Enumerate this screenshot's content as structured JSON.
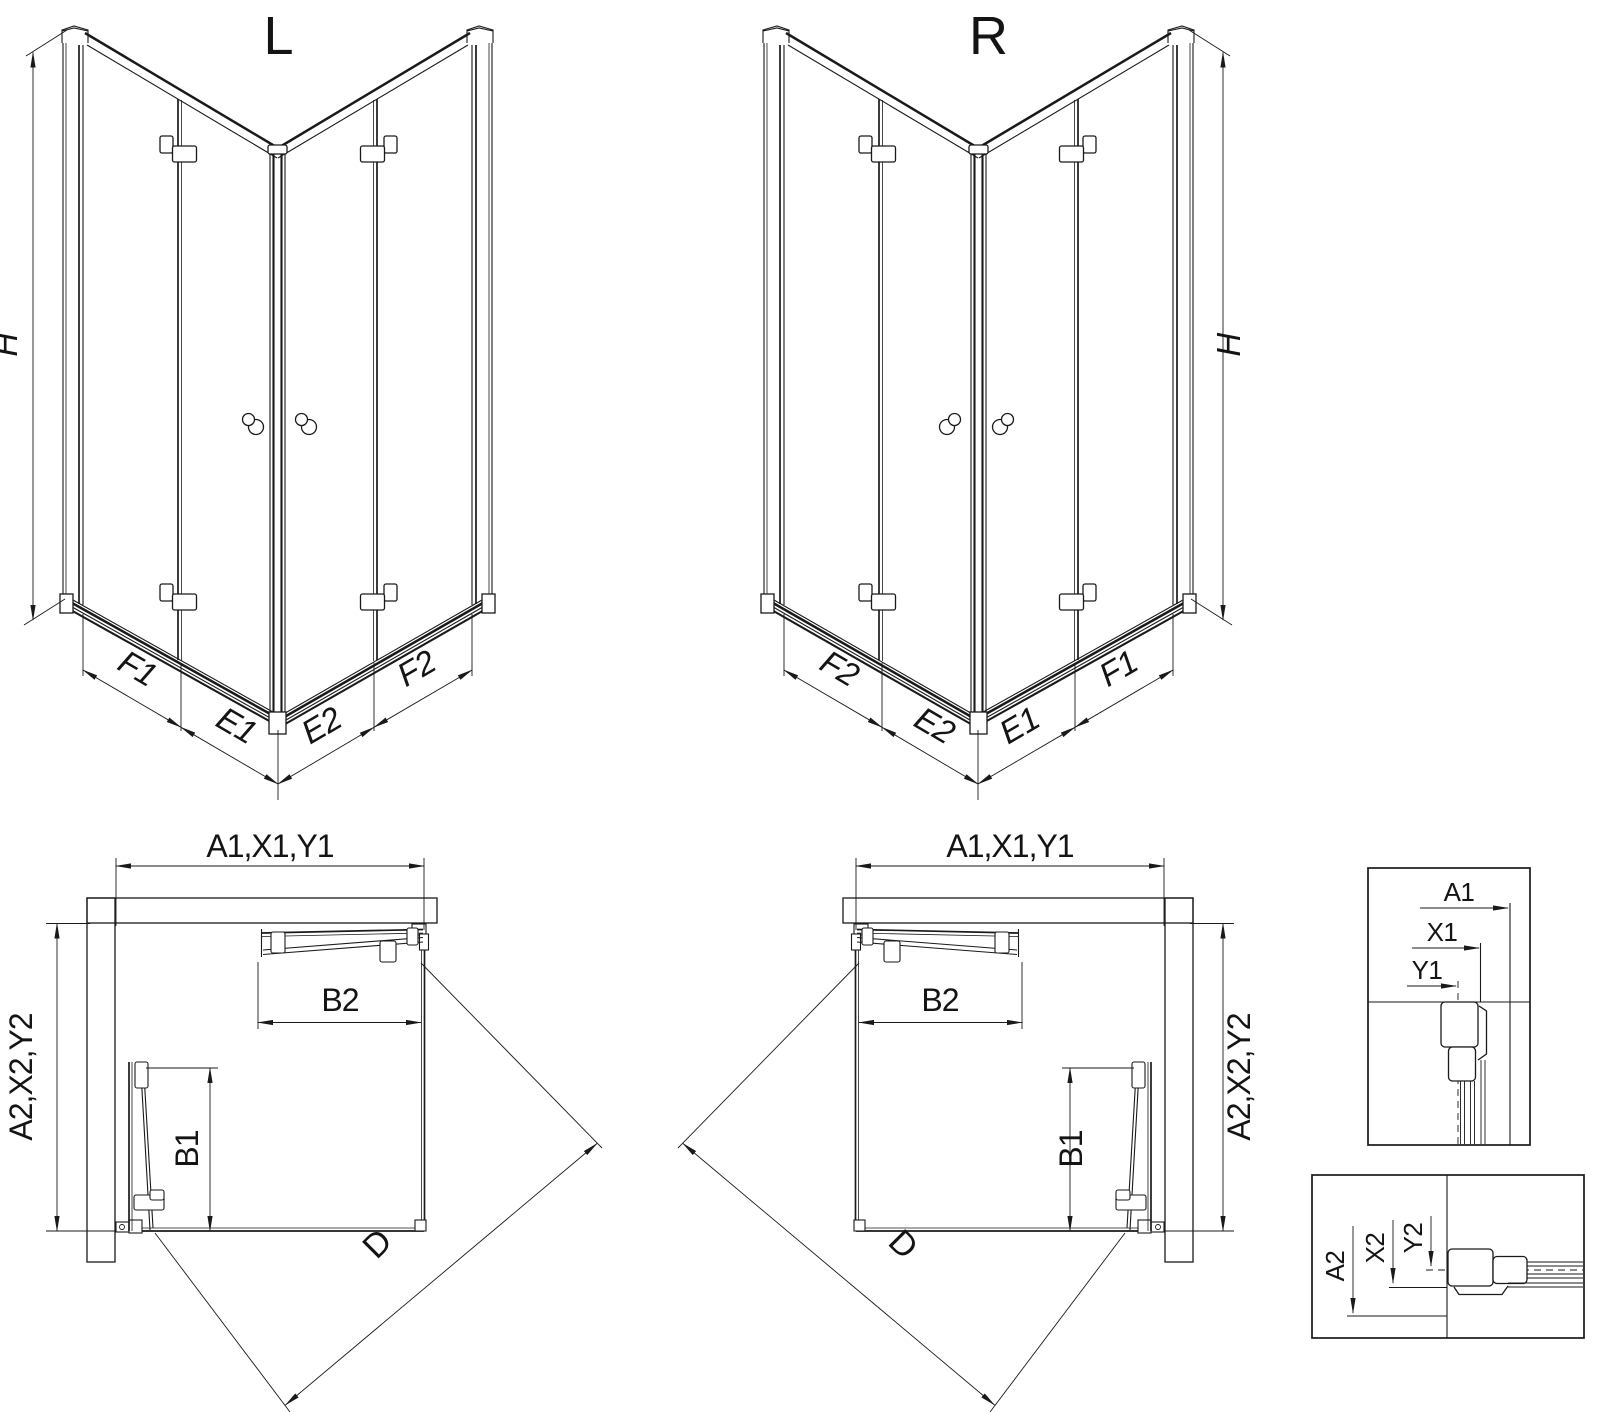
{
  "drawing": {
    "type": "shower-enclosure-technical-drawing",
    "colors": {
      "line": "#1a1a1a",
      "background": "#ffffff"
    }
  },
  "iso_left": {
    "title": "L",
    "dim_height": "H",
    "dim_left_outer": "F1",
    "dim_left_inner": "E1",
    "dim_right_inner": "E2",
    "dim_right_outer": "F2"
  },
  "iso_right": {
    "title": "R",
    "dim_height": "H",
    "dim_left_outer": "F2",
    "dim_left_inner": "E2",
    "dim_right_inner": "E1",
    "dim_right_outer": "F1"
  },
  "plan_left": {
    "dim_width": "A1,X1,Y1",
    "dim_depth": "A2,X2,Y2",
    "dim_door_top": "B2",
    "dim_door_side": "B1",
    "dim_diagonal": "D"
  },
  "plan_right": {
    "dim_width": "A1,X1,Y1",
    "dim_depth": "A2,X2,Y2",
    "dim_door_top": "B2",
    "dim_door_side": "B1",
    "dim_diagonal": "D"
  },
  "detail_top": {
    "dim_a": "A1",
    "dim_x": "X1",
    "dim_y": "Y1"
  },
  "detail_bottom": {
    "dim_a": "A2",
    "dim_x": "X2",
    "dim_y": "Y2"
  }
}
